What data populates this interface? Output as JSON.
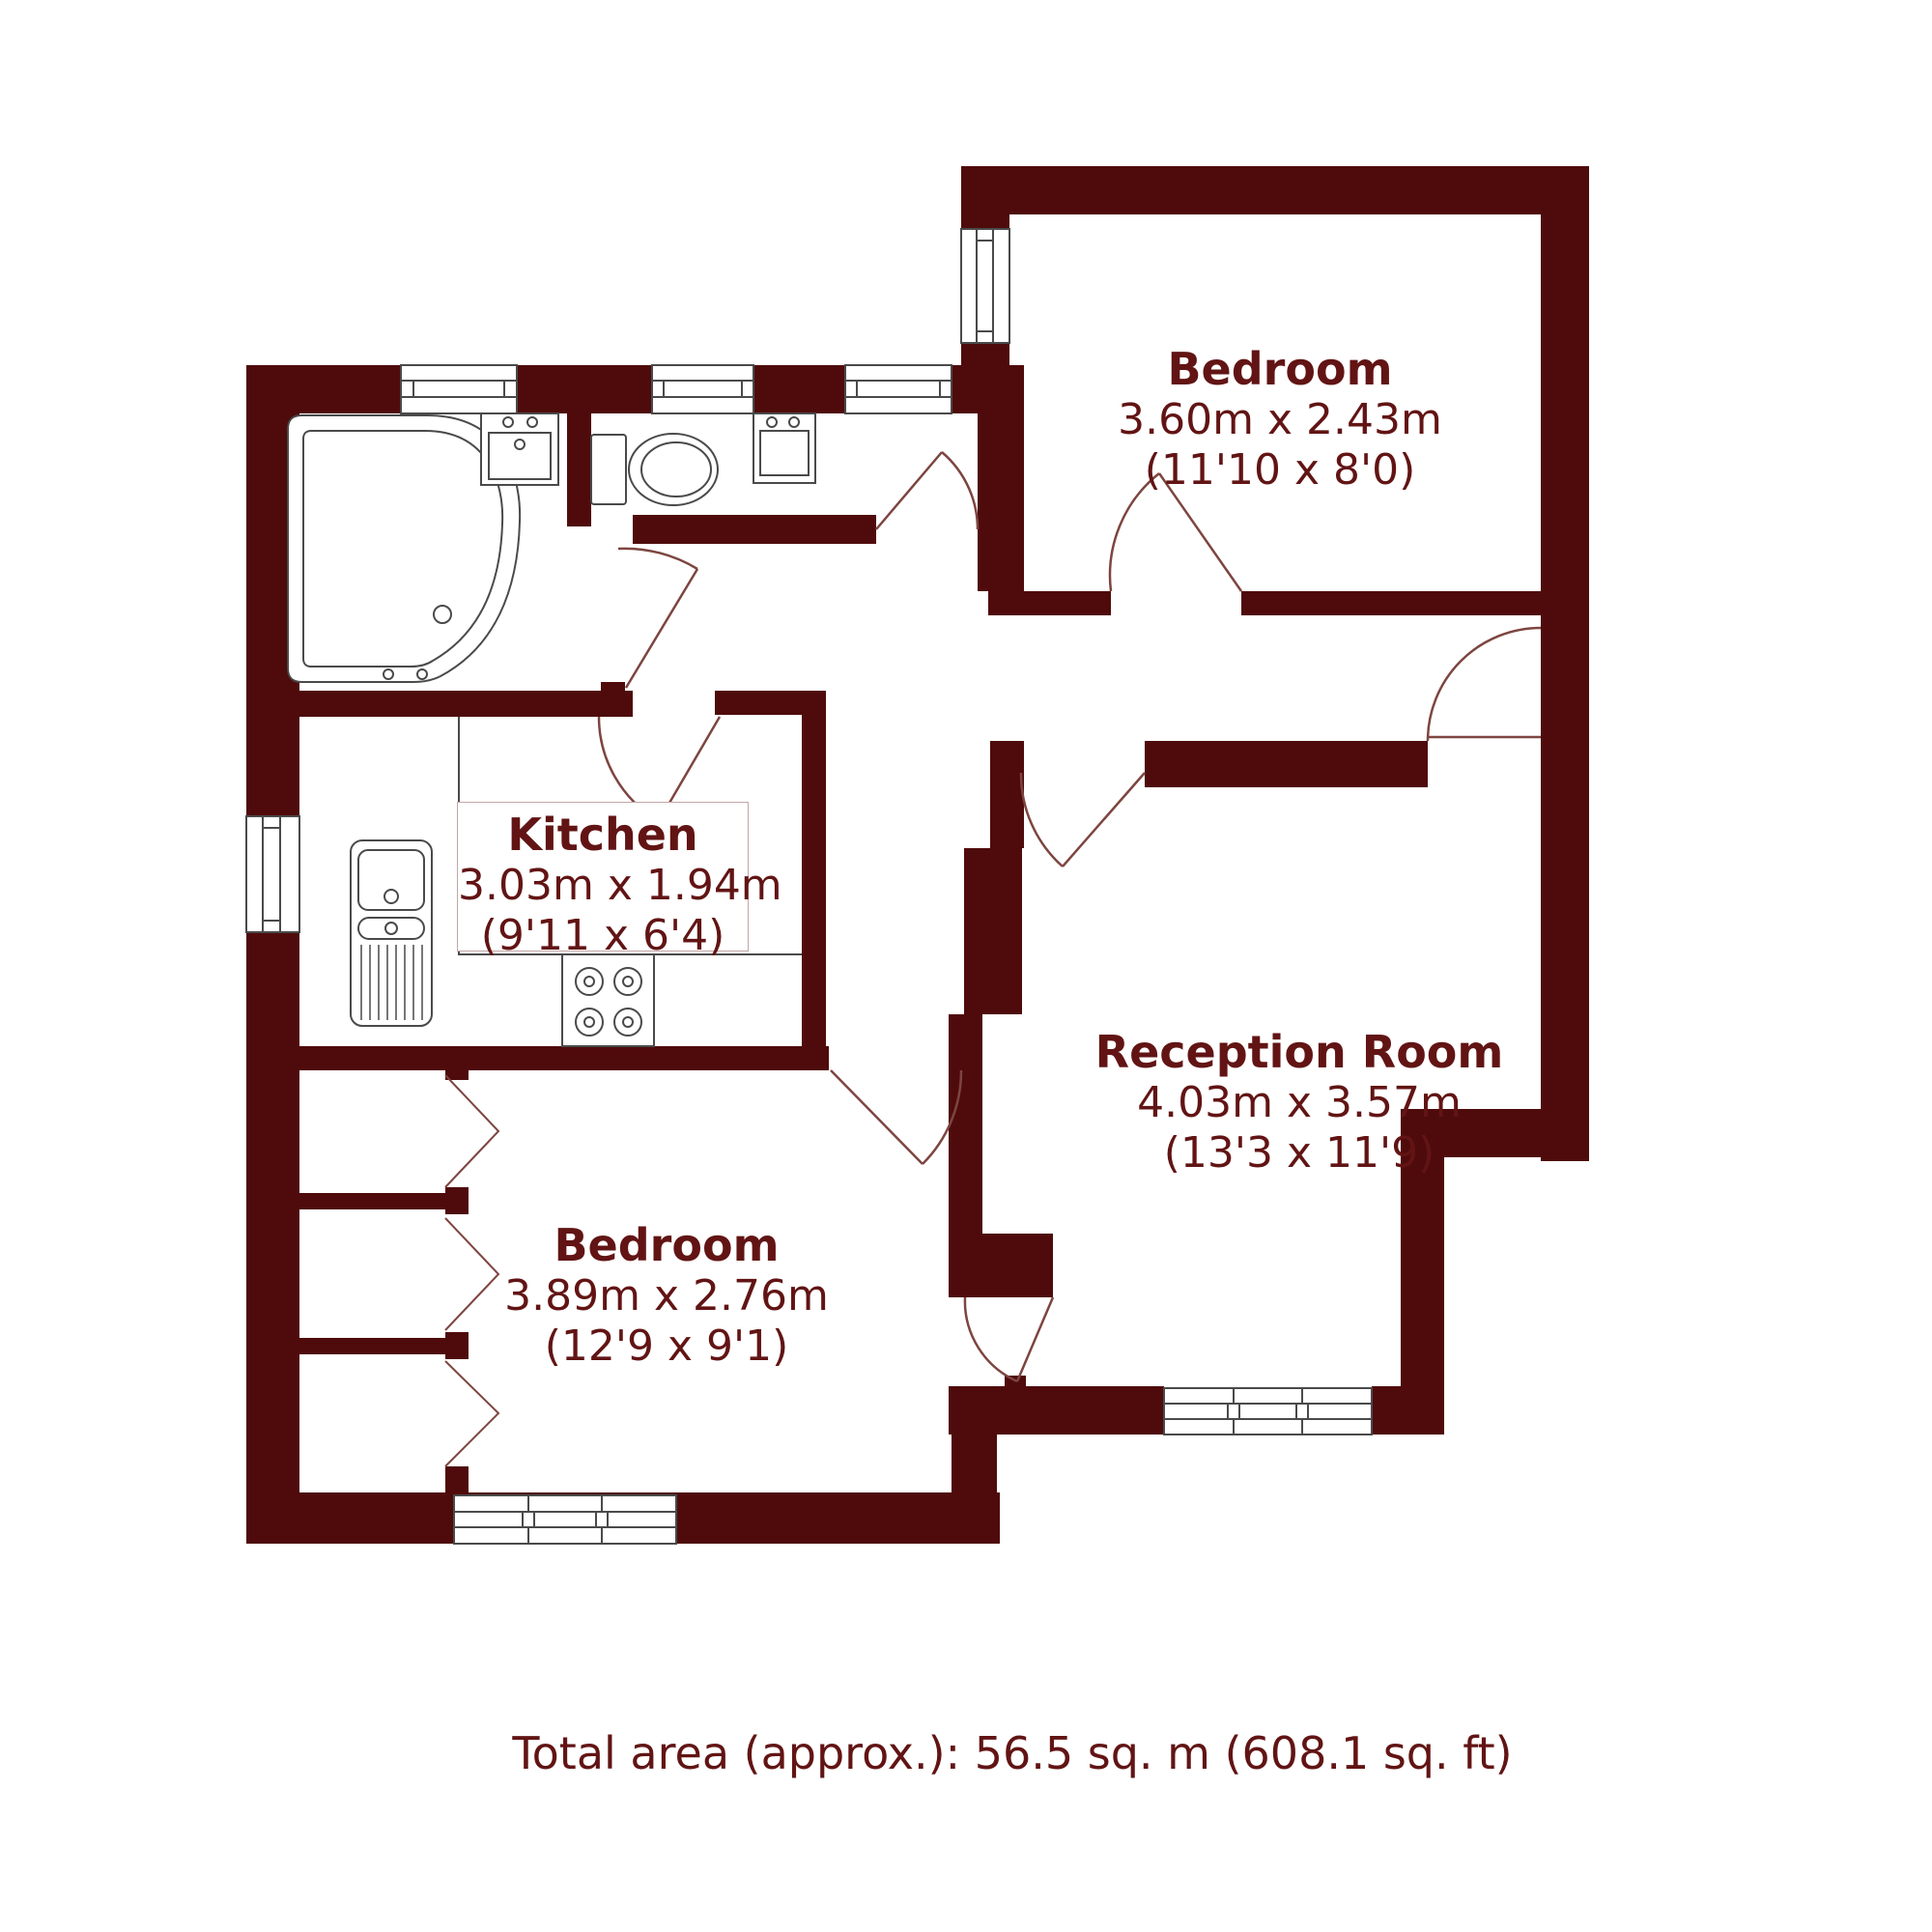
{
  "plan": {
    "type": "floorplan",
    "rooms": [
      {
        "id": "bedroom-top",
        "name": "Bedroom",
        "metric": "3.60m x 2.43m",
        "imperial": "(11'10 x 8'0)"
      },
      {
        "id": "kitchen",
        "name": "Kitchen",
        "metric": "3.03m x 1.94m",
        "imperial": "(9'11 x 6'4)"
      },
      {
        "id": "reception",
        "name": "Reception Room",
        "metric": "4.03m x 3.57m",
        "imperial": "(13'3 x 11'9)"
      },
      {
        "id": "bedroom-left",
        "name": "Bedroom",
        "metric": "3.89m x 2.76m",
        "imperial": "(12'9 x 9'1)"
      }
    ],
    "total_area": "Total area (approx.): 56.5 sq. m (608.1 sq. ft)",
    "colors": {
      "wall": "#4f0b0b",
      "door_line": "#7d4540",
      "fixture_line": "#4a4a4a",
      "text": "#621414",
      "label_box_border": "#c4a6a6"
    }
  }
}
